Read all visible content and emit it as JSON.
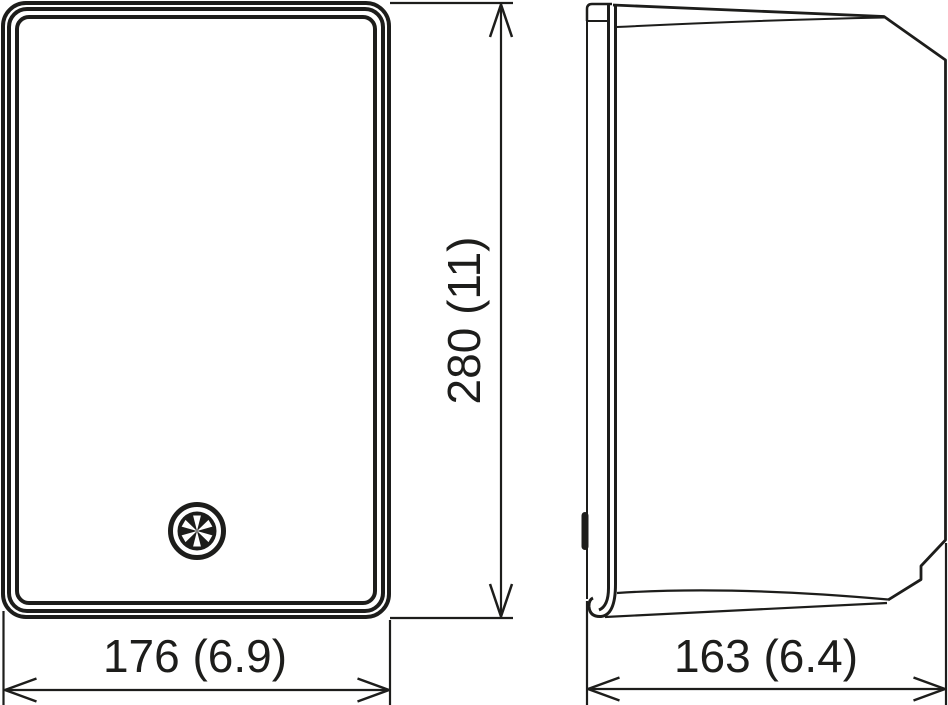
{
  "drawing": {
    "colors": {
      "line": "#1d1d1b",
      "background": "#ffffff"
    },
    "dimensions": {
      "height": {
        "label": "280 (11)",
        "value_mm": 280,
        "value_in": 11
      },
      "width": {
        "label": "176 (6.9)",
        "value_mm": 176,
        "value_in": 6.9
      },
      "depth": {
        "label": "163 (6.4)",
        "value_mm": 163,
        "value_in": 6.4
      }
    },
    "icons": {
      "front_badge": "emblem-badge-icon"
    }
  }
}
